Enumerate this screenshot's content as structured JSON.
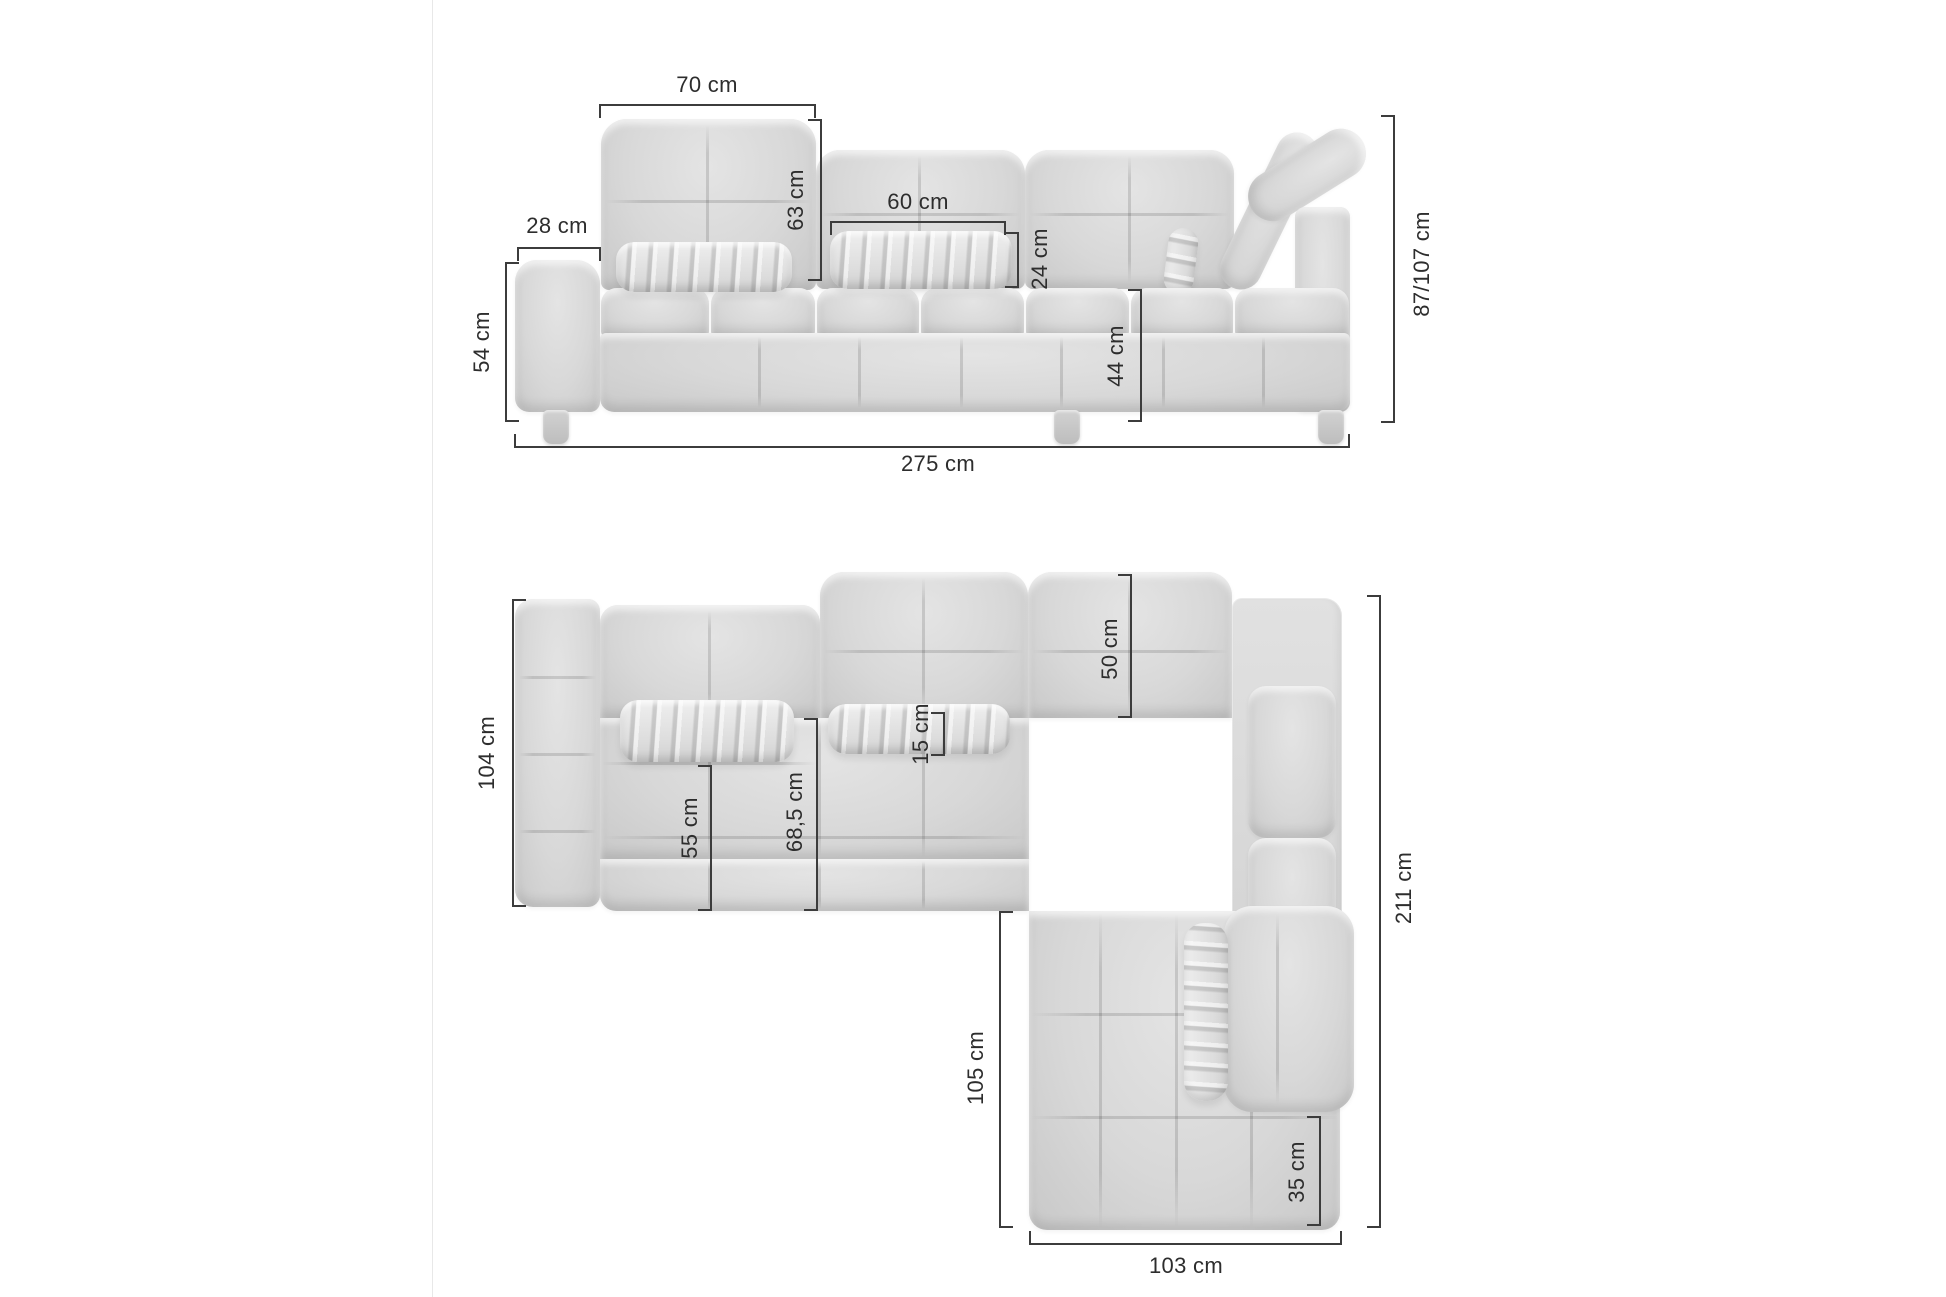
{
  "image": {
    "description": "Corner sofa dimension diagram with front elevation view and top plan view",
    "unit": "cm",
    "colors": {
      "background": "#ffffff",
      "sofa_gray": "#d8d8d8",
      "dim_line": "#3c3c3c",
      "label_text": "#2d2d2d",
      "divider": "#e8e8e8"
    }
  },
  "front_view": {
    "name": "front-elevation",
    "dimensions": [
      {
        "id": "backrest_width",
        "label": "70 cm"
      },
      {
        "id": "backrest_height",
        "label": "63 cm"
      },
      {
        "id": "armrest_width",
        "label": "28 cm"
      },
      {
        "id": "pillow_width",
        "label": "60 cm"
      },
      {
        "id": "pillow_height",
        "label": "24 cm"
      },
      {
        "id": "armrest_height",
        "label": "54 cm"
      },
      {
        "id": "seat_height",
        "label": "44 cm"
      },
      {
        "id": "total_height",
        "label": "87/107 cm"
      },
      {
        "id": "total_width",
        "label": "275 cm"
      }
    ]
  },
  "top_view": {
    "name": "top-plan",
    "dimensions": [
      {
        "id": "sofa_depth",
        "label": "104 cm"
      },
      {
        "id": "backrest_depth",
        "label": "50 cm"
      },
      {
        "id": "pillow_depth",
        "label": "15 cm"
      },
      {
        "id": "seat_depth",
        "label": "55 cm"
      },
      {
        "id": "seat_depth_full",
        "label": "68,5 cm"
      },
      {
        "id": "side_length",
        "label": "211 cm"
      },
      {
        "id": "chaise_length",
        "label": "105 cm"
      },
      {
        "id": "corner_width",
        "label": "35 cm"
      },
      {
        "id": "chaise_width",
        "label": "103 cm"
      }
    ]
  }
}
